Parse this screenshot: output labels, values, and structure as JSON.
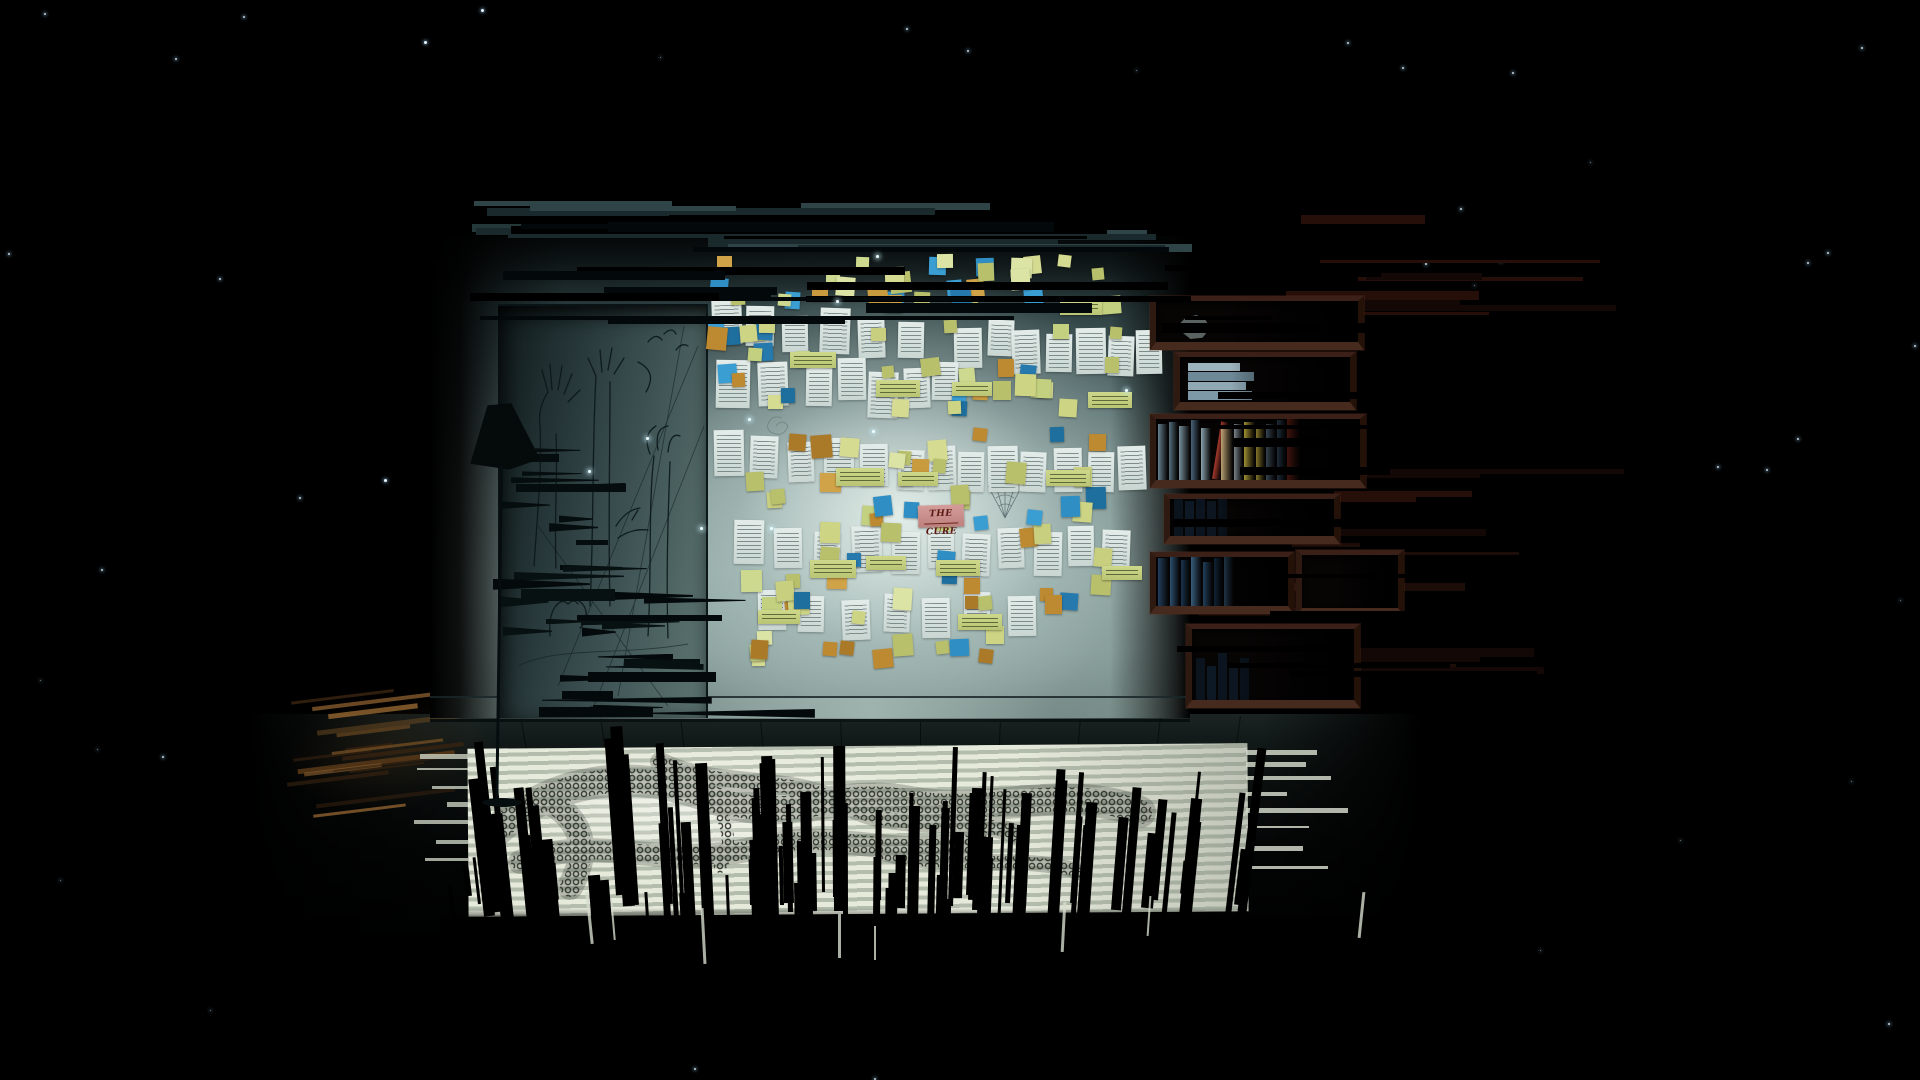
{
  "game": {
    "visible_text": {
      "cure_note": "THE CURE"
    },
    "colors": {
      "background": "#000000",
      "wall_bright": "#c2d4d0",
      "wall_dark": "#131e20",
      "note_blue": "#2f8fc4",
      "note_yellowgreen": "#c8cf7e",
      "note_lightgreen": "#ccd98f",
      "note_orange": "#bd8a31",
      "note_pink": "#cf9793",
      "paper": "#dde7e4",
      "shelf_wood": "#3a2016",
      "floor_light": "#e6eadb",
      "warm_light": "#8a5f2e",
      "star": "#e8f6ff"
    }
  },
  "cure_note": {
    "text": "THE CURE"
  },
  "stars": [
    [
      44,
      13,
      2
    ],
    [
      243,
      16,
      2
    ],
    [
      424,
      41,
      3
    ],
    [
      906,
      28,
      2
    ],
    [
      967,
      50,
      2
    ],
    [
      1136,
      70,
      1
    ],
    [
      1347,
      42,
      2
    ],
    [
      1402,
      67,
      2
    ],
    [
      1512,
      72,
      2
    ],
    [
      1861,
      47,
      2
    ],
    [
      8,
      253,
      2
    ],
    [
      175,
      58,
      2
    ],
    [
      219,
      278,
      2
    ],
    [
      481,
      9,
      3
    ],
    [
      1460,
      208,
      2
    ],
    [
      1425,
      263,
      2
    ],
    [
      1500,
      260,
      2
    ],
    [
      1474,
      285,
      1
    ],
    [
      1827,
      252,
      2
    ],
    [
      1807,
      262,
      2
    ],
    [
      384,
      479,
      3
    ],
    [
      101,
      569,
      2
    ],
    [
      299,
      497,
      2
    ],
    [
      1914,
      345,
      2
    ],
    [
      1590,
      162,
      1
    ],
    [
      162,
      756,
      2
    ],
    [
      97,
      749,
      1
    ],
    [
      318,
      906,
      2
    ],
    [
      744,
      959,
      2
    ],
    [
      1188,
      841,
      2
    ],
    [
      1717,
      466,
      2
    ],
    [
      1766,
      469,
      2
    ],
    [
      1797,
      438,
      2
    ],
    [
      1851,
      781,
      1
    ],
    [
      1888,
      1023,
      2
    ],
    [
      1377,
      919,
      2
    ],
    [
      694,
      1068,
      2
    ],
    [
      874,
      1078,
      2
    ],
    [
      566,
      640,
      2
    ],
    [
      1080,
      253,
      1
    ],
    [
      660,
      57,
      1
    ],
    [
      60,
      880,
      1
    ],
    [
      210,
      1010,
      1
    ],
    [
      1540,
      950,
      1
    ],
    [
      1680,
      840,
      1
    ],
    [
      40,
      680,
      1
    ],
    [
      1900,
      600,
      1
    ],
    [
      1240,
      980,
      1
    ]
  ],
  "sparkles": [
    [
      876,
      255
    ],
    [
      748,
      418
    ],
    [
      646,
      437
    ],
    [
      700,
      527
    ],
    [
      770,
      527
    ],
    [
      588,
      470
    ],
    [
      836,
      300
    ],
    [
      1125,
      389
    ],
    [
      872,
      430
    ]
  ],
  "note_palettes": {
    "blue": [
      "#2f8fc4",
      "#2679ad",
      "#3b9ed2",
      "#1f6f9e"
    ],
    "yg": [
      "#c8cf7e",
      "#d6db92",
      "#b9c06c",
      "#cdd584"
    ],
    "lg": [
      "#ccd98f",
      "#dbe4a4",
      "#c2d07f"
    ],
    "or": [
      "#bd8a31",
      "#c99b3f",
      "#ab7a28",
      "#d0a348"
    ]
  },
  "note_weights": [
    [
      "blue",
      0.22
    ],
    [
      "yg",
      0.36
    ],
    [
      "lg",
      0.2
    ],
    [
      "or",
      0.22
    ]
  ],
  "note_clusters": [
    {
      "region": [
        706,
        252,
        450,
        64
      ],
      "count": 30,
      "seed": 11
    },
    {
      "region": [
        706,
        316,
        452,
        110
      ],
      "count": 34,
      "seed": 22
    },
    {
      "region": [
        740,
        426,
        400,
        120
      ],
      "count": 34,
      "seed": 33
    },
    {
      "region": [
        706,
        546,
        430,
        78
      ],
      "count": 22,
      "seed": 44
    },
    {
      "region": [
        730,
        624,
        360,
        56
      ],
      "count": 12,
      "seed": 55
    }
  ],
  "papers": [
    [
      712,
      300,
      30,
      44,
      -2
    ],
    [
      746,
      306,
      28,
      40,
      1
    ],
    [
      782,
      316,
      26,
      36,
      -1
    ],
    [
      820,
      308,
      30,
      46,
      2
    ],
    [
      858,
      318,
      27,
      40,
      -2
    ],
    [
      898,
      322,
      26,
      36,
      1
    ],
    [
      954,
      328,
      28,
      40,
      -1
    ],
    [
      988,
      320,
      26,
      36,
      2
    ],
    [
      1012,
      330,
      28,
      44,
      -2
    ],
    [
      1046,
      334,
      26,
      38,
      1
    ],
    [
      1076,
      328,
      30,
      46,
      -1
    ],
    [
      1108,
      336,
      26,
      40,
      2
    ],
    [
      1136,
      330,
      26,
      44,
      -1
    ],
    [
      716,
      360,
      34,
      48,
      1
    ],
    [
      758,
      362,
      30,
      44,
      -2
    ],
    [
      806,
      368,
      26,
      38,
      1
    ],
    [
      838,
      358,
      28,
      42,
      -1
    ],
    [
      868,
      372,
      30,
      46,
      2
    ],
    [
      904,
      368,
      26,
      40,
      -2
    ],
    [
      932,
      362,
      26,
      38,
      1
    ],
    [
      714,
      430,
      30,
      46,
      -1
    ],
    [
      750,
      436,
      28,
      42,
      2
    ],
    [
      788,
      442,
      26,
      40,
      -2
    ],
    [
      824,
      438,
      30,
      46,
      1
    ],
    [
      860,
      444,
      28,
      42,
      -1
    ],
    [
      898,
      450,
      26,
      40,
      2
    ],
    [
      928,
      446,
      28,
      44,
      -2
    ],
    [
      958,
      452,
      26,
      40,
      1
    ],
    [
      988,
      446,
      30,
      46,
      -1
    ],
    [
      1020,
      452,
      26,
      40,
      2
    ],
    [
      1054,
      448,
      28,
      44,
      -1
    ],
    [
      1088,
      452,
      26,
      40,
      1
    ],
    [
      1118,
      446,
      28,
      44,
      -2
    ],
    [
      734,
      520,
      30,
      44,
      1
    ],
    [
      774,
      528,
      28,
      40,
      -1
    ],
    [
      814,
      532,
      26,
      38,
      2
    ],
    [
      852,
      526,
      30,
      46,
      -2
    ],
    [
      892,
      532,
      28,
      42,
      1
    ],
    [
      928,
      528,
      26,
      40,
      -1
    ],
    [
      962,
      534,
      28,
      42,
      2
    ],
    [
      998,
      528,
      26,
      40,
      -2
    ],
    [
      1034,
      532,
      28,
      44,
      1
    ],
    [
      1068,
      526,
      26,
      40,
      -1
    ],
    [
      1102,
      530,
      28,
      42,
      2
    ],
    [
      758,
      590,
      28,
      40,
      -1
    ],
    [
      798,
      596,
      26,
      36,
      1
    ],
    [
      842,
      600,
      28,
      40,
      -2
    ],
    [
      884,
      594,
      26,
      38,
      2
    ],
    [
      922,
      598,
      28,
      40,
      -1
    ],
    [
      964,
      592,
      26,
      36,
      1
    ],
    [
      1008,
      596,
      28,
      40,
      -1
    ]
  ],
  "green_labels": [
    [
      790,
      352,
      46,
      16
    ],
    [
      876,
      380,
      44,
      17
    ],
    [
      952,
      382,
      40,
      14
    ],
    [
      836,
      468,
      48,
      18
    ],
    [
      898,
      472,
      40,
      14
    ],
    [
      1046,
      470,
      44,
      16
    ],
    [
      810,
      560,
      46,
      18
    ],
    [
      866,
      556,
      40,
      14
    ],
    [
      936,
      560,
      44,
      16
    ],
    [
      1088,
      392,
      44,
      16
    ],
    [
      758,
      610,
      42,
      14
    ],
    [
      958,
      614,
      44,
      16
    ],
    [
      1060,
      300,
      42,
      15
    ],
    [
      1102,
      566,
      40,
      14
    ]
  ],
  "shelves": [
    {
      "x": 1150,
      "y": 296,
      "w": 210,
      "h": 54,
      "type": "dark",
      "ball": true
    },
    {
      "x": 1174,
      "y": 352,
      "w": 178,
      "h": 58,
      "type": "stack"
    },
    {
      "x": 1150,
      "y": 414,
      "w": 212,
      "h": 74,
      "type": "books"
    },
    {
      "x": 1164,
      "y": 494,
      "w": 172,
      "h": 50,
      "type": "dark2"
    },
    {
      "x": 1150,
      "y": 552,
      "w": 140,
      "h": 62,
      "type": "books2"
    },
    {
      "x": 1296,
      "y": 550,
      "w": 104,
      "h": 66,
      "type": "dark"
    },
    {
      "x": 1186,
      "y": 624,
      "w": 170,
      "h": 84,
      "type": "dark2"
    }
  ],
  "colorbooks": [
    {
      "c": "#66808f",
      "w": 10,
      "h": 56
    },
    {
      "c": "#55707f",
      "w": 9,
      "h": 58
    },
    {
      "c": "#77919e",
      "w": 11,
      "h": 54
    },
    {
      "c": "#49637a",
      "w": 9,
      "h": 60
    },
    {
      "c": "#89a3ad",
      "w": 10,
      "h": 52
    },
    {
      "c": "#a83a2b",
      "w": 8,
      "h": 58,
      "lean": 9
    },
    {
      "c": "#bfa677",
      "w": 12,
      "h": 54
    },
    {
      "c": "#8d98a1",
      "w": 9,
      "h": 56
    },
    {
      "c": "#cdb83f",
      "w": 11,
      "h": 58
    },
    {
      "c": "#c2ae3d",
      "w": 9,
      "h": 52
    },
    {
      "c": "#5a7288",
      "w": 10,
      "h": 56
    },
    {
      "c": "#3e5a74",
      "w": 9,
      "h": 60
    },
    {
      "c": "#992f20",
      "w": 13,
      "h": 62
    }
  ],
  "navybooks": [
    {
      "c": "#223f5c",
      "w": 11,
      "h": 48
    },
    {
      "c": "#2c5070",
      "w": 10,
      "h": 50
    },
    {
      "c": "#1a344c",
      "w": 9,
      "h": 46
    },
    {
      "c": "#365c7c",
      "w": 11,
      "h": 50
    },
    {
      "c": "#254766",
      "w": 10,
      "h": 44
    },
    {
      "c": "#142e46",
      "w": 9,
      "h": 48
    },
    {
      "c": "#31516e",
      "w": 10,
      "h": 50
    }
  ],
  "stackbooks": [
    {
      "c": "#7d98a6",
      "h": 9,
      "w": 64
    },
    {
      "c": "#8fa8b4",
      "h": 8,
      "w": 58
    },
    {
      "c": "#6d8997",
      "h": 9,
      "w": 66
    },
    {
      "c": "#9db3bd",
      "h": 8,
      "w": 52
    }
  ],
  "faintbooks": [
    "#0d1925",
    "#122031",
    "#0e1a28",
    "#101c2a",
    "#0b1622"
  ],
  "bar_generators": [
    {
      "name": "wall-top-light",
      "seed": 7,
      "region": [
        470,
        200,
        700,
        46
      ],
      "count": 20,
      "palette": [
        "#24383a",
        "#1a2a2c",
        "#2e4446"
      ],
      "wmin": 70,
      "wmax": 480,
      "hmin": 3,
      "hmax": 9,
      "z": 4
    },
    {
      "name": "wall-top-black",
      "seed": 8,
      "region": [
        470,
        212,
        720,
        108
      ],
      "count": 18,
      "palette": [
        "#000000",
        "#03080a"
      ],
      "wmin": 90,
      "wmax": 620,
      "hmin": 3,
      "hmax": 10,
      "z": 6
    },
    {
      "name": "shelf-maroon",
      "seed": 9,
      "region": [
        1170,
        214,
        330,
        480
      ],
      "count": 26,
      "palette": [
        "#1c0d08",
        "#260f09",
        "#140806"
      ],
      "wmin": 60,
      "wmax": 300,
      "hmin": 3,
      "hmax": 9,
      "z": 5
    },
    {
      "name": "shelf-black",
      "seed": 10,
      "region": [
        1150,
        250,
        280,
        450
      ],
      "count": 16,
      "palette": [
        "#000000"
      ],
      "wmin": 80,
      "wmax": 260,
      "hmin": 4,
      "hmax": 10,
      "z": 7
    }
  ],
  "flag_generators": [
    {
      "seed": 12,
      "region": [
        486,
        556,
        224,
        158
      ],
      "count": 26,
      "palette": [
        "#040a0b",
        "#081112"
      ],
      "wmin": 30,
      "wmax": 170,
      "hmin": 5,
      "hmax": 12
    },
    {
      "seed": 13,
      "region": [
        498,
        442,
        180,
        112
      ],
      "count": 10,
      "palette": [
        "#060d0e"
      ],
      "wmin": 24,
      "wmax": 110,
      "hmin": 4,
      "hmax": 9
    }
  ],
  "spikes": {
    "seed": 21,
    "xmin": 450,
    "xmax": 1255,
    "count": 95,
    "hmin": 28,
    "hmax": 185,
    "wmin": 3,
    "wmax": 13,
    "centerx": 850,
    "tilt": 0.018
  },
  "slivers": [
    [
      148,
      150,
      3,
      52,
      -6
    ],
    [
      172,
      158,
      2,
      40,
      -5
    ],
    [
      262,
      166,
      3,
      56,
      -3
    ],
    [
      398,
      172,
      3,
      44,
      0
    ],
    [
      622,
      160,
      3,
      50,
      3
    ],
    [
      708,
      154,
      2,
      40,
      4
    ],
    [
      434,
      184,
      2,
      34,
      0
    ],
    [
      920,
      150,
      3,
      46,
      6
    ]
  ],
  "fingers_left": {
    "seed": 31,
    "rows": [
      12,
      26,
      44,
      60,
      78,
      98,
      116
    ],
    "wmin": 18,
    "wmax": 62
  },
  "fingers_right": {
    "seed": 32,
    "rows": [
      8,
      20,
      34,
      50,
      66,
      84,
      104,
      124
    ],
    "wmin": 40,
    "wmax": 120
  },
  "warm_streaks": {
    "seed": 41,
    "count": 16,
    "palette": [
      "#6e4a22",
      "#8a5f2e",
      "#543618",
      "#3a2410"
    ],
    "wmin": 40,
    "wmax": 170
  },
  "seams": [
    [
      520,
      -10
    ],
    [
      600,
      -8
    ],
    [
      680,
      -6
    ],
    [
      760,
      -4
    ],
    [
      840,
      -2
    ],
    [
      920,
      0
    ],
    [
      1000,
      2
    ],
    [
      1080,
      4
    ],
    [
      1160,
      6
    ],
    [
      1240,
      8
    ]
  ]
}
